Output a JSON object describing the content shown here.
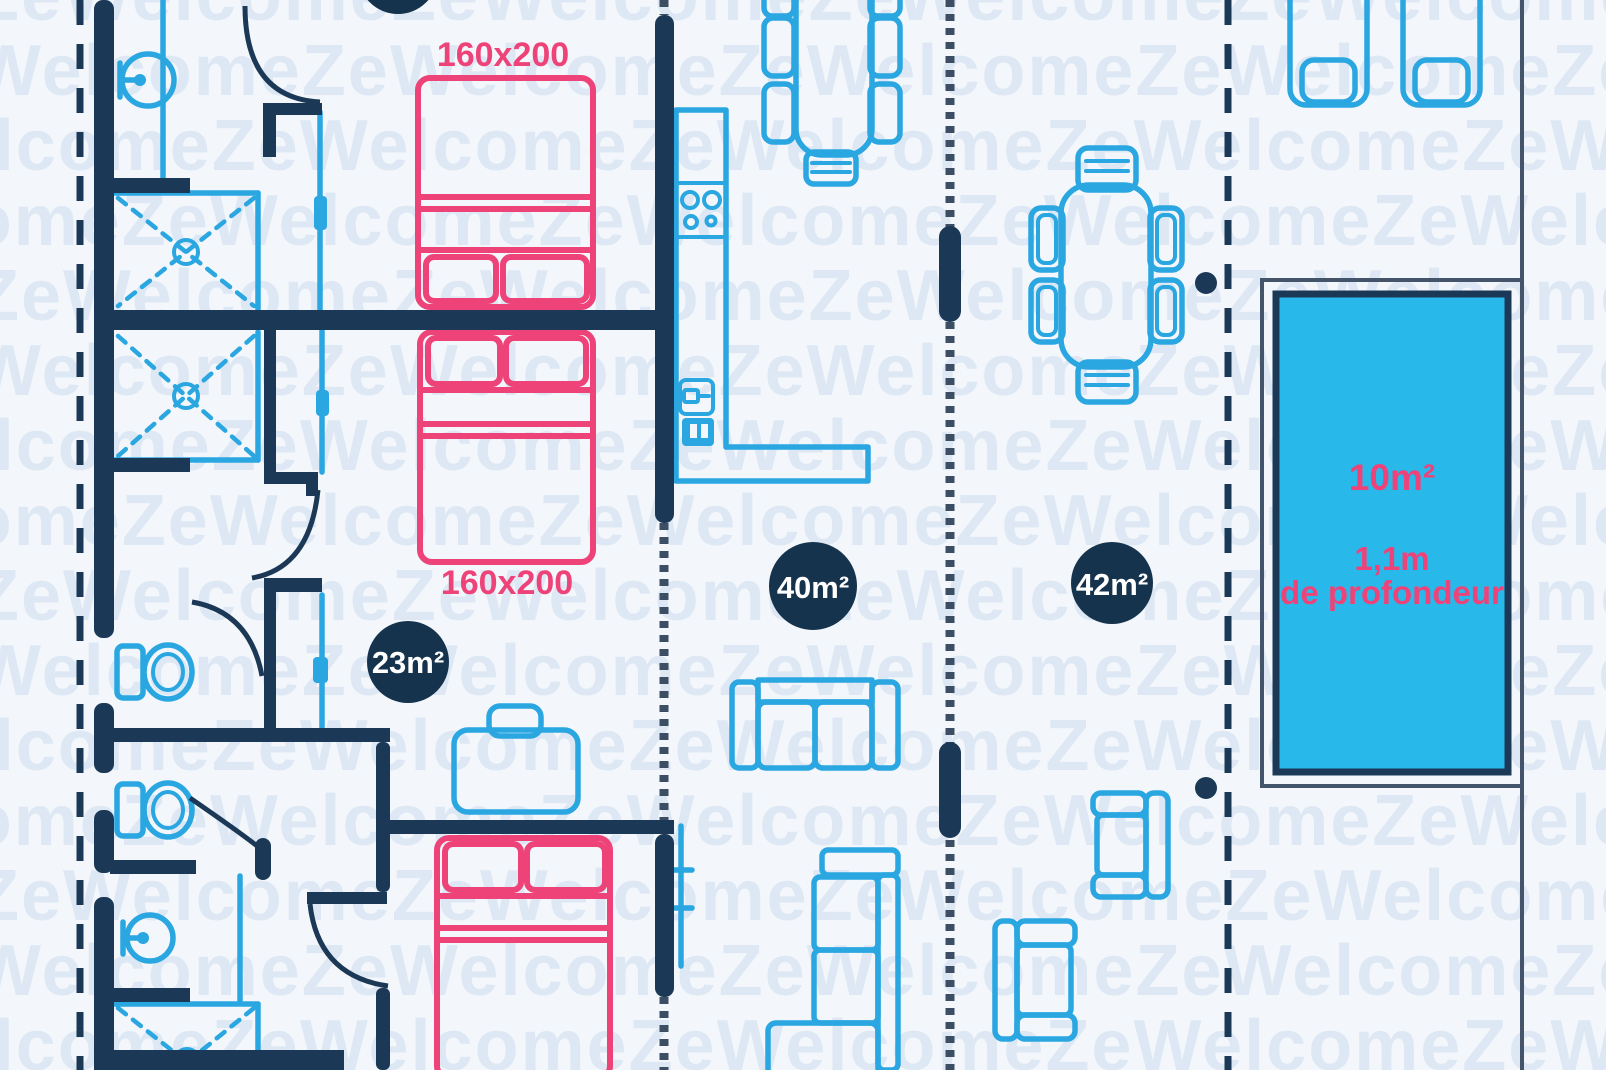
{
  "watermark": {
    "text": "ZeWelcome"
  },
  "labels": {
    "bed_top": "160x200",
    "bed_middle": "160x200",
    "badge_bedroom": "23m²",
    "badge_living": "40m²",
    "badge_main": "42m²",
    "pool_area": "10m²",
    "pool_depth": "1,1m",
    "pool_depth_caption": "de profondeur"
  },
  "colors": {
    "background": "#f3f7fb",
    "watermark": "#dde8f4",
    "wall": "#1b3956",
    "badge_fill": "#16334d",
    "badge_text": "#ffffff",
    "fixture": "#2aa6e1",
    "bed": "#ee4379",
    "pool_fill": "#29b8ea",
    "pool_text": "#ee4379",
    "hatch": "#3c4e63",
    "terrace_line": "#44546a"
  },
  "furniture_icons": [
    "washbasin-icon",
    "shower-icon",
    "toilet-icon",
    "double-bed-icon",
    "suitcase-icon",
    "kitchen-counter-icon",
    "cooktop-icon",
    "kitchen-sink-icon",
    "dishwasher-icon",
    "dining-table-icon",
    "chair-icon",
    "sofa-icon",
    "corner-sofa-icon",
    "armchair-icon",
    "sun-lounger-icon",
    "swimming-pool-icon",
    "door-arc-icon"
  ]
}
